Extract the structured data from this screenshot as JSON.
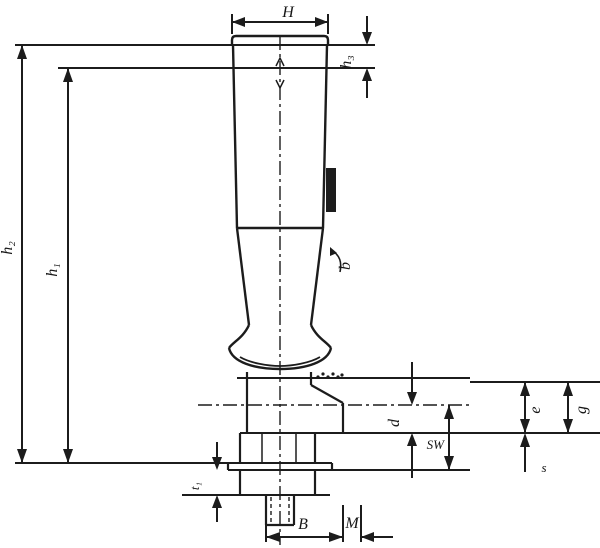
{
  "drawing": {
    "kind": "technical dimension drawing of a machine handle with threaded stud",
    "colors": {
      "line": "#1c1c1c",
      "background": "#ffffff",
      "text": "#161616"
    },
    "labels": {
      "width_top": "H",
      "height_top_section": "h₃",
      "height_outer": "h₂",
      "height_inner": "h₁",
      "clip_detail": "b",
      "boss_diameter": "d",
      "across_flats": "SW",
      "flange_detail_left": "e",
      "flange_detail_right": "g",
      "groove_small": "s",
      "skirt_height": "t₁",
      "stud_width": "B",
      "thread": "M"
    }
  }
}
